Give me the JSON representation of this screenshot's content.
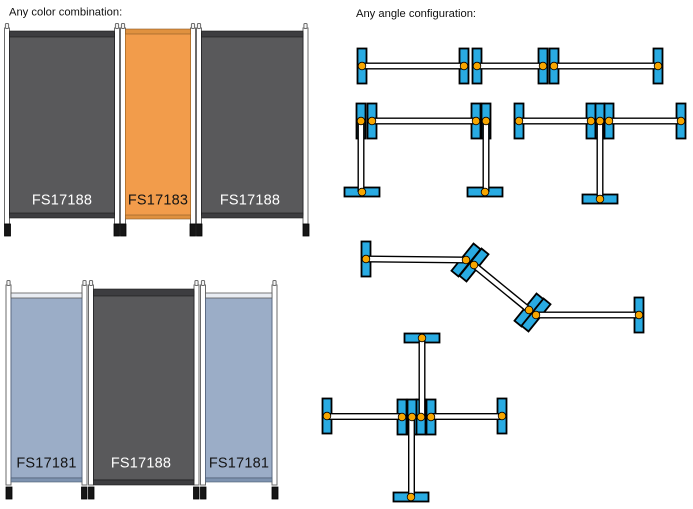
{
  "headings": {
    "left": "Any color combination:",
    "right": "Any angle configuration:"
  },
  "screens": [
    {
      "panels": [
        {
          "code": "FS17188",
          "color": "dark-gray"
        },
        {
          "code": "FS17183",
          "color": "orange"
        },
        {
          "code": "FS17188",
          "color": "dark-gray"
        }
      ]
    },
    {
      "panels": [
        {
          "code": "FS17181",
          "color": "light-blue"
        },
        {
          "code": "FS17188",
          "color": "dark-gray"
        },
        {
          "code": "FS17181",
          "color": "light-blue"
        }
      ]
    }
  ],
  "configurations": [
    "straight-line",
    "u-bridge",
    "t-shape",
    "zigzag",
    "cross"
  ],
  "colors": {
    "panel_dark": "#59595B",
    "panel_orange": "#F29C4B",
    "panel_blue": "#9BADC7",
    "foot_blue": "#29ABE2",
    "hinge_orange": "#F7A600"
  }
}
